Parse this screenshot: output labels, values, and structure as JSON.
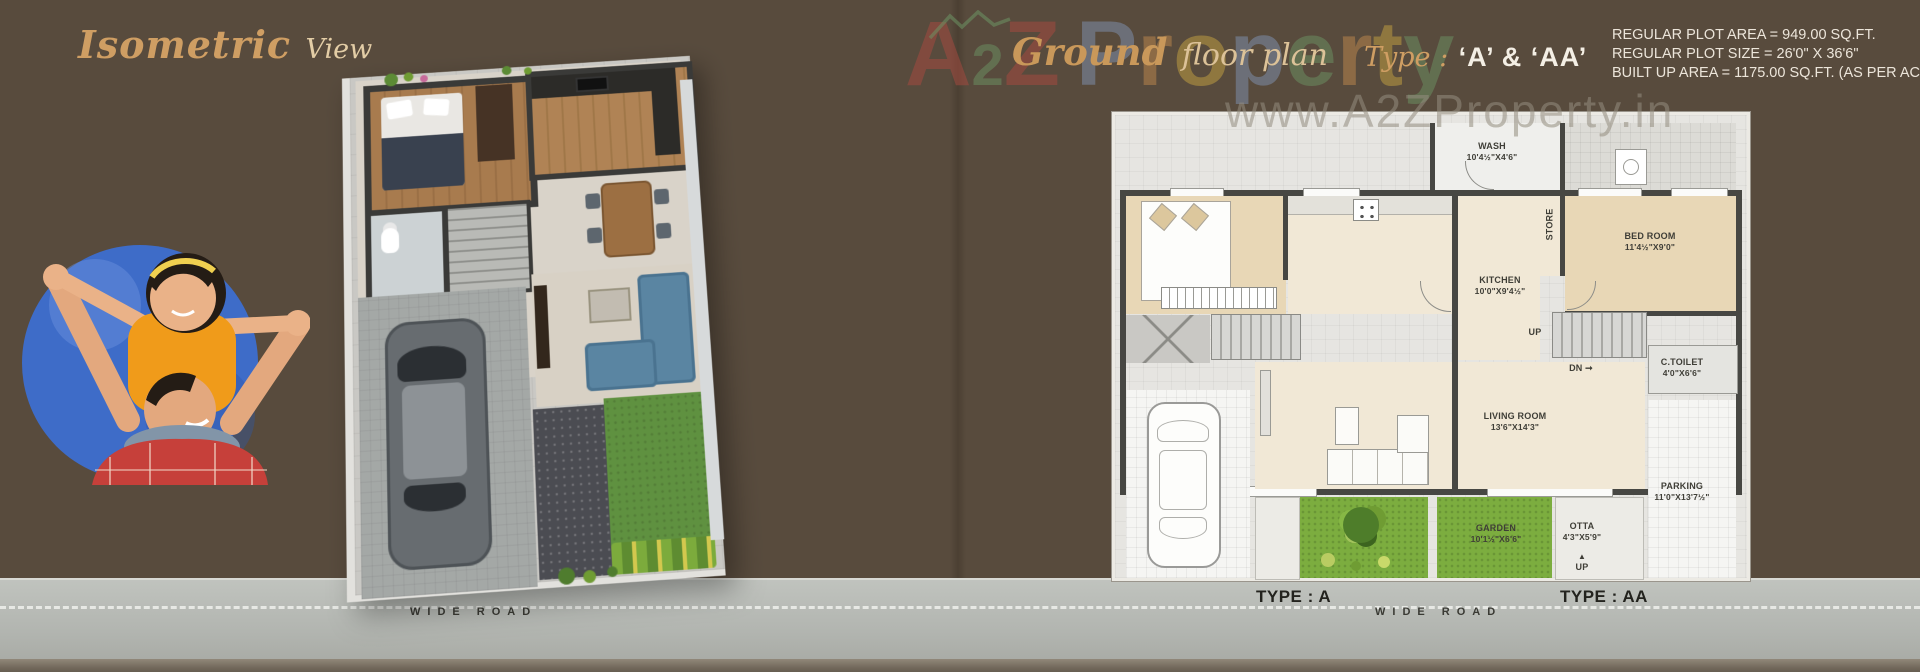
{
  "left_page": {
    "title_main": "Isometric",
    "title_sub": "View"
  },
  "header": {
    "ground": "Ground",
    "floor_plan": "floor plan",
    "type_label": "Type :",
    "type_value": "‘A’ & ‘AA’"
  },
  "specs": {
    "lines": [
      "REGULAR PLOT AREA = 949.00 SQ.FT.",
      "REGULAR PLOT SIZE = 26'0\" X 36'6\"",
      "BUILT UP AREA = 1175.00 SQ.FT. (AS PER ACTUAL)"
    ]
  },
  "watermark": {
    "letters": [
      {
        "ch": "A",
        "color": "#aa4a40"
      },
      {
        "ch": "2",
        "color": "#6d9464",
        "small": true
      },
      {
        "ch": "Z",
        "color": "#aa4a40"
      },
      {
        "ch": "P",
        "color": "#8093b4",
        "gap": true
      },
      {
        "ch": "r",
        "color": "#c08a4d"
      },
      {
        "ch": "o",
        "color": "#c6a441"
      },
      {
        "ch": "p",
        "color": "#8093b4"
      },
      {
        "ch": "e",
        "color": "#6d9464"
      },
      {
        "ch": "r",
        "color": "#c08a4d"
      },
      {
        "ch": "t",
        "color": "#c6a441"
      },
      {
        "ch": "y",
        "color": "#6d9464"
      }
    ],
    "url": "www.A2ZProperty.in"
  },
  "plan": {
    "rooms": {
      "wash": {
        "name": "WASH",
        "dim": "10'4½\"X4'6\""
      },
      "bedroom": {
        "name": "BED ROOM",
        "dim": "11'4½\"X9'0\""
      },
      "kitchen": {
        "name": "KITCHEN",
        "dim": "10'0\"X9'4½\""
      },
      "store": {
        "name": "STORE"
      },
      "ctoilet": {
        "name": "C.TOILET",
        "dim": "4'0\"X6'6\""
      },
      "living": {
        "name": "LIVING ROOM",
        "dim": "13'6\"X14'3\""
      },
      "garden": {
        "name": "GARDEN",
        "dim": "10'1½\"X6'6\""
      },
      "otta": {
        "name": "OTTA",
        "dim": "4'3\"X5'9\""
      },
      "parking": {
        "name": "PARKING",
        "dim": "11'0\"X13'7½\""
      }
    },
    "stairs_up": "UP",
    "stairs_dn": "DN",
    "otta_up": "UP"
  },
  "footer": {
    "wide_road": "WIDE ROAD",
    "type_a": "TYPE : A",
    "type_aa": "TYPE : AA"
  },
  "colors": {
    "background": "#584b3d",
    "title_accent": "#cf9e63",
    "plan_wall": "#474743",
    "garden_green": "#7cad3f",
    "road_gray": "#b2b5b0"
  }
}
